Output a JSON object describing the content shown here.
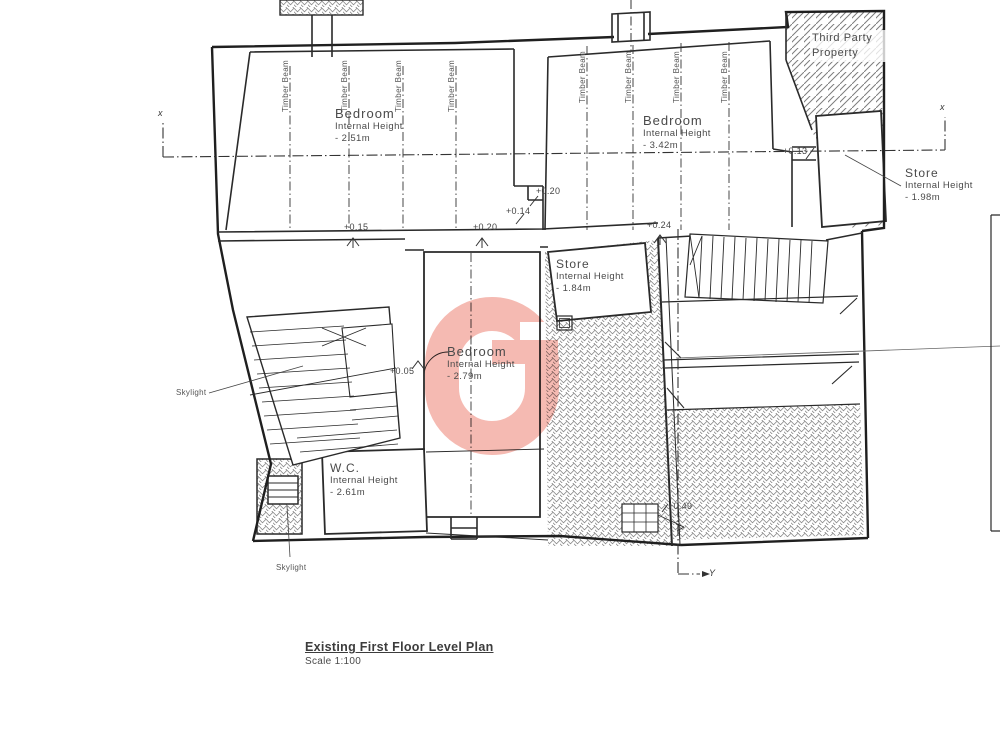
{
  "drawing": {
    "title": "Existing First Floor Level Plan",
    "scale": "Scale 1:100"
  },
  "rooms": {
    "bedroom_left": {
      "name": "Bedroom",
      "sub": "Internal Height",
      "height": "- 2.51m"
    },
    "bedroom_right": {
      "name": "Bedroom",
      "sub": "Internal Height",
      "height": "- 3.42m"
    },
    "bedroom_center": {
      "name": "Bedroom",
      "sub": "Internal Height",
      "height": "- 2.79m"
    },
    "store_middle": {
      "name": "Store",
      "sub": "Internal Height",
      "height": "- 1.84m"
    },
    "store_right": {
      "name": "Store",
      "sub": "Internal Height",
      "height": "- 1.98m"
    },
    "wc": {
      "name": "W.C.",
      "sub": "Internal Height",
      "height": "- 2.61m"
    }
  },
  "annotations": {
    "third_party": "Third Party Property",
    "skylight": "Skylight",
    "timber_beam": "Timber Beam"
  },
  "levels": {
    "a": "+0.15",
    "b": "+0.20",
    "c": "+0.20",
    "d": "+0.14",
    "e": "+0.24",
    "f": "+0.13",
    "g": "+0.05",
    "h": "+0.49"
  },
  "sections": {
    "x": "x",
    "y": "Y"
  },
  "colors": {
    "ink": "#2a2a2a",
    "watermark": "#f5bab2"
  }
}
